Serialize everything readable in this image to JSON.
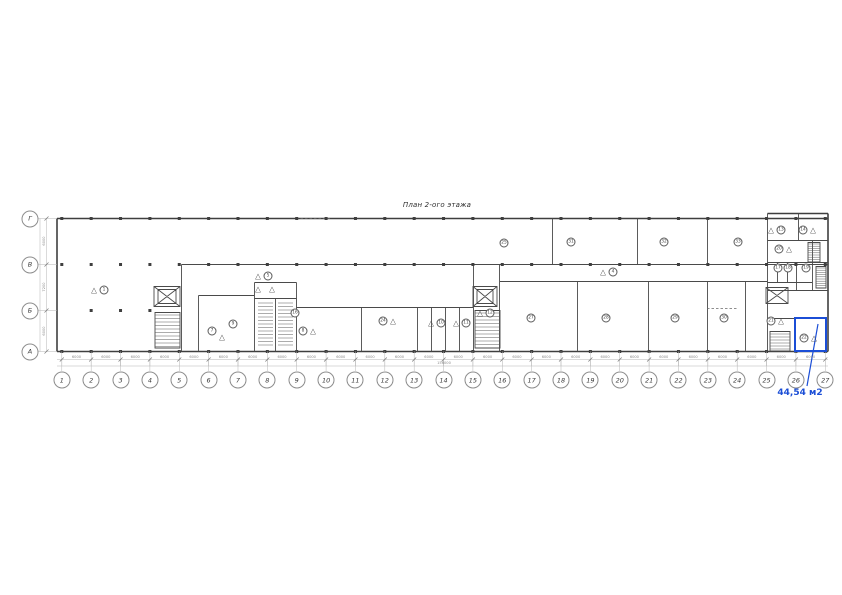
{
  "page": {
    "title": "План 2-ого этажа"
  },
  "colors": {
    "accent_blue": "#1b4ed6",
    "wall": "#3f3f3f",
    "grid": "#a0a0a0"
  },
  "selection": {
    "area_label": "44,54 м2"
  },
  "icons": {
    "triangle_marker": "△"
  },
  "axes": {
    "cols": [
      "1",
      "2",
      "3",
      "4",
      "5",
      "6",
      "7",
      "8",
      "9",
      "10",
      "11",
      "12",
      "13",
      "14",
      "15",
      "16",
      "17",
      "18",
      "19",
      "20",
      "21",
      "22",
      "23",
      "24",
      "25",
      "26",
      "27"
    ],
    "rows": [
      "Г",
      "В",
      "Б",
      "А"
    ]
  },
  "rooms": [
    {
      "label": "1",
      "tri": "left"
    },
    {
      "label": "5",
      "tri": "left"
    },
    {
      "label": "4",
      "tri": "left"
    },
    {
      "label": "25",
      "tri": null
    },
    {
      "label": "31",
      "tri": null
    },
    {
      "label": "32",
      "tri": null
    },
    {
      "label": "33",
      "tri": null
    },
    {
      "label": "27",
      "tri": null
    },
    {
      "label": "28",
      "tri": null
    },
    {
      "label": "29",
      "tri": null
    },
    {
      "label": "30",
      "tri": null
    },
    {
      "label": "16",
      "tri": null
    },
    {
      "label": "9",
      "tri": null
    },
    {
      "label": "7",
      "tri": null
    },
    {
      "label": "8",
      "tri": "right"
    },
    {
      "label": "24",
      "tri": "right"
    },
    {
      "label": "10",
      "tri": "left"
    },
    {
      "label": "11",
      "tri": "left"
    },
    {
      "label": "12",
      "tri": "left"
    },
    {
      "label": "13",
      "tri": "left"
    },
    {
      "label": "14",
      "tri": "right"
    },
    {
      "label": "20",
      "tri": "right"
    },
    {
      "label": "17",
      "tri": null
    },
    {
      "label": "18",
      "tri": null
    },
    {
      "label": "19",
      "tri": null
    },
    {
      "label": "21",
      "tri": "right"
    },
    {
      "label": "22",
      "tri": "right"
    }
  ],
  "dimensions": {
    "bottom_bays": [
      "6000",
      "6000",
      "6000",
      "6000",
      "6000",
      "6000",
      "6000",
      "6000",
      "6000",
      "6000",
      "6000",
      "6000",
      "6000",
      "6000",
      "6000",
      "6000",
      "6000",
      "6000",
      "6000",
      "6000",
      "6000",
      "6000",
      "6000",
      "6000",
      "6000",
      "6000"
    ],
    "bottom_total": "156000",
    "left_bays": [
      "6000",
      "7200",
      "6000"
    ]
  }
}
